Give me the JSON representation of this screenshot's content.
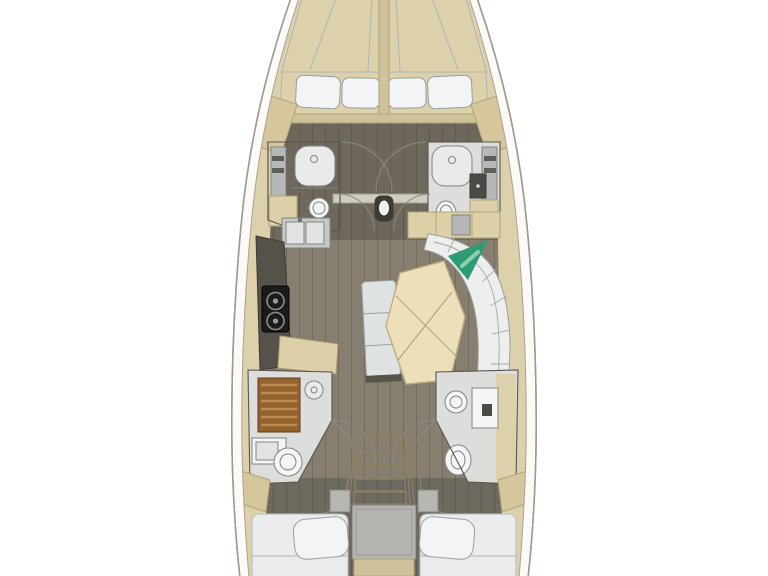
{
  "diagram": {
    "type": "floor-plan",
    "subject": "sailing-yacht-interior-deck-plan",
    "orientation": "bow-at-top",
    "elements": [
      "forward-vberth-cabin",
      "forward-head-port",
      "forward-head-starboard",
      "mast-post",
      "galley-port",
      "salon-dinette-starboard",
      "aft-head-port-with-shower",
      "aft-head-starboard",
      "companionway-stairs",
      "engine-compartment",
      "aft-cabin-port",
      "aft-cabin-starboard"
    ]
  },
  "colors": {
    "page_bg": "#ffffff",
    "hull_fill": "#fbfaf7",
    "hull_stroke": "#a09a8e",
    "deck_trim": "#ddd1ab",
    "floor_fwd": "#6e675c",
    "floor_main": "#867e6f",
    "floor_aft": "#6f6a5f",
    "mattress": "#d6d9db",
    "bed_white": "#e9ebec",
    "pillow": "#f2f4f5",
    "bed_frame": "#cfc29b",
    "wardrobe": "#d5c69c",
    "bath_floor": "#dddddb",
    "counter_gray": "#b6b8b7",
    "counter_dark": "#56524a",
    "stove": "#1b1b1b",
    "sink_steel": "#c7c9c8",
    "basin": "#e2e3e3",
    "white_fixture": "#f4f5f4",
    "shower_wood": "#92622f",
    "shower_slat": "#c08a4e",
    "table": "#ecdfb9",
    "bench": "#dfe2e3",
    "bench_end": "#565349",
    "sofa": "#edefef",
    "green_pillow": "#2d9c72",
    "green_light": "#8fd0b4",
    "stair_tread": "#e6dcbc",
    "stair_frame": "#cfc5a2",
    "engine_box": "#b5b4b0",
    "mast": "#3b3a36",
    "beam": "#d3ccba",
    "sideboard": "#ddd0a8",
    "dark_cabinet": "#4b4a45",
    "shower_glass": "#e9ebeb",
    "nightstand": "#b7b6b2"
  }
}
